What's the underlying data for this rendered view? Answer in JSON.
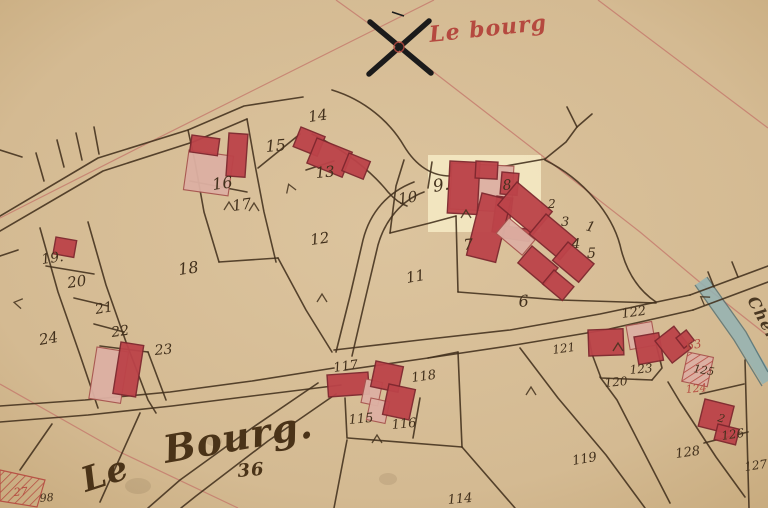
{
  "map": {
    "type": "cadastral-plan",
    "colors": {
      "paper": "#dcc49e",
      "paper_edge": "#c8ab7e",
      "ink": "#42301c",
      "building_red": "#bc4349",
      "building_red_stroke": "#7e272e",
      "building_pink": "#ddb0a3",
      "building_pink_stroke": "#a7544f",
      "red_ink": "#b5493f",
      "survey_line": "#c4786c",
      "water_blue": "#93b3b4",
      "water_edge": "#4e6e74",
      "highlight": "#f7eec8",
      "cross": "#1b1b1b"
    },
    "titles": [
      {
        "text": "Le bourg",
        "x": 430,
        "y": 42,
        "size": 22,
        "rot": -6,
        "color": "#b5493f"
      },
      {
        "text": "Le",
        "x": 86,
        "y": 492,
        "size": 34,
        "rot": -18,
        "color": "#4a3318"
      },
      {
        "text": "Bourg.",
        "x": 166,
        "y": 463,
        "size": 38,
        "rot": -10,
        "color": "#4a3318"
      },
      {
        "text": "36",
        "x": 238,
        "y": 477,
        "size": 18,
        "rot": -5,
        "color": "#4a3318"
      },
      {
        "text": "Chem",
        "x": 747,
        "y": 300,
        "size": 16,
        "rot": 62,
        "color": "#4a3822"
      }
    ],
    "parcel_labels": [
      {
        "text": "14",
        "x": 309,
        "y": 122,
        "size": 15,
        "rot": -8
      },
      {
        "text": "15",
        "x": 266,
        "y": 152,
        "size": 16,
        "rot": -5
      },
      {
        "text": "16",
        "x": 213,
        "y": 190,
        "size": 16,
        "rot": -8
      },
      {
        "text": "13",
        "x": 316,
        "y": 178,
        "size": 15,
        "rot": -5
      },
      {
        "text": "17",
        "x": 233,
        "y": 211,
        "size": 15,
        "rot": -8
      },
      {
        "text": "10",
        "x": 399,
        "y": 204,
        "size": 15,
        "rot": -8
      },
      {
        "text": "9.",
        "x": 434,
        "y": 192,
        "size": 17,
        "rot": -10
      },
      {
        "text": "8",
        "x": 503,
        "y": 190,
        "size": 14,
        "rot": -5
      },
      {
        "text": "2",
        "x": 548,
        "y": 208,
        "size": 12,
        "rot": 0
      },
      {
        "text": "3",
        "x": 561,
        "y": 226,
        "size": 13,
        "rot": 0
      },
      {
        "text": "1",
        "x": 585,
        "y": 230,
        "size": 14,
        "rot": 15
      },
      {
        "text": "4",
        "x": 572,
        "y": 248,
        "size": 13,
        "rot": 0
      },
      {
        "text": "5",
        "x": 587,
        "y": 258,
        "size": 14,
        "rot": 0
      },
      {
        "text": "7",
        "x": 464,
        "y": 250,
        "size": 15,
        "rot": -5
      },
      {
        "text": "12",
        "x": 311,
        "y": 245,
        "size": 15,
        "rot": -8
      },
      {
        "text": "11",
        "x": 407,
        "y": 283,
        "size": 15,
        "rot": -10
      },
      {
        "text": "18",
        "x": 179,
        "y": 275,
        "size": 16,
        "rot": -8
      },
      {
        "text": "19.",
        "x": 42,
        "y": 264,
        "size": 14,
        "rot": -8
      },
      {
        "text": "20",
        "x": 68,
        "y": 288,
        "size": 15,
        "rot": -8
      },
      {
        "text": "21",
        "x": 96,
        "y": 314,
        "size": 14,
        "rot": -10
      },
      {
        "text": "22",
        "x": 112,
        "y": 337,
        "size": 14,
        "rot": -8
      },
      {
        "text": "23",
        "x": 155,
        "y": 355,
        "size": 14,
        "rot": -5
      },
      {
        "text": "24",
        "x": 40,
        "y": 345,
        "size": 15,
        "rot": -10
      },
      {
        "text": "6",
        "x": 519,
        "y": 307,
        "size": 16,
        "rot": -5
      },
      {
        "text": "122",
        "x": 622,
        "y": 318,
        "size": 13,
        "rot": -8
      },
      {
        "text": "121",
        "x": 553,
        "y": 354,
        "size": 12,
        "rot": -8
      },
      {
        "text": "123",
        "x": 630,
        "y": 374,
        "size": 12,
        "rot": -5
      },
      {
        "text": "120",
        "x": 605,
        "y": 387,
        "size": 12,
        "rot": -5
      },
      {
        "text": "63",
        "x": 687,
        "y": 350,
        "size": 12,
        "rot": -10,
        "color": "#b5493f"
      },
      {
        "text": "125",
        "x": 693,
        "y": 372,
        "size": 11,
        "rot": 10
      },
      {
        "text": "124",
        "x": 686,
        "y": 393,
        "size": 11,
        "rot": -5,
        "color": "#b5493f"
      },
      {
        "text": "2",
        "x": 717,
        "y": 421,
        "size": 11,
        "rot": 15
      },
      {
        "text": "117",
        "x": 334,
        "y": 372,
        "size": 13,
        "rot": -8
      },
      {
        "text": "118",
        "x": 412,
        "y": 382,
        "size": 13,
        "rot": -8
      },
      {
        "text": "115",
        "x": 349,
        "y": 424,
        "size": 13,
        "rot": -5
      },
      {
        "text": "116",
        "x": 392,
        "y": 429,
        "size": 13,
        "rot": -5
      },
      {
        "text": "119",
        "x": 573,
        "y": 465,
        "size": 13,
        "rot": -10
      },
      {
        "text": "128",
        "x": 676,
        "y": 458,
        "size": 13,
        "rot": -8
      },
      {
        "text": "126",
        "x": 722,
        "y": 440,
        "size": 12,
        "rot": -8
      },
      {
        "text": "127",
        "x": 745,
        "y": 471,
        "size": 12,
        "rot": -8
      },
      {
        "text": "114",
        "x": 448,
        "y": 504,
        "size": 13,
        "rot": -5
      },
      {
        "text": "27",
        "x": 14,
        "y": 496,
        "size": 11,
        "rot": -5,
        "color": "#b5493f"
      },
      {
        "text": "98",
        "x": 40,
        "y": 502,
        "size": 11,
        "rot": -5
      }
    ],
    "buildings": [
      {
        "x": 189,
        "y": 150,
        "w": 45,
        "h": 40,
        "rot": 8,
        "fill": "pink"
      },
      {
        "x": 192,
        "y": 135,
        "w": 28,
        "h": 17,
        "rot": 8,
        "fill": "red"
      },
      {
        "x": 229,
        "y": 133,
        "w": 19,
        "h": 43,
        "rot": 4,
        "fill": "red"
      },
      {
        "x": 301,
        "y": 127,
        "w": 26,
        "h": 21,
        "rot": 22,
        "fill": "red"
      },
      {
        "x": 317,
        "y": 138,
        "w": 38,
        "h": 27,
        "rot": 22,
        "fill": "red"
      },
      {
        "x": 349,
        "y": 153,
        "w": 23,
        "h": 19,
        "rot": 22,
        "fill": "red"
      },
      {
        "x": 56,
        "y": 237,
        "w": 21,
        "h": 17,
        "rot": 10,
        "fill": "red"
      },
      {
        "x": 97,
        "y": 347,
        "w": 32,
        "h": 52,
        "rot": 9,
        "fill": "pink"
      },
      {
        "x": 121,
        "y": 342,
        "w": 23,
        "h": 52,
        "rot": 9,
        "fill": "red"
      },
      {
        "x": 452,
        "y": 163,
        "w": 62,
        "h": 46,
        "rot": 3,
        "fill": "pink"
      },
      {
        "x": 450,
        "y": 161,
        "w": 30,
        "h": 52,
        "rot": 3,
        "fill": "red"
      },
      {
        "x": 476,
        "y": 161,
        "w": 22,
        "h": 17,
        "rot": 3,
        "fill": "red"
      },
      {
        "x": 502,
        "y": 172,
        "w": 17,
        "h": 22,
        "rot": 5,
        "fill": "red"
      },
      {
        "x": 497,
        "y": 196,
        "w": 16,
        "h": 36,
        "rot": 8,
        "fill": "red"
      },
      {
        "x": 482,
        "y": 193,
        "w": 30,
        "h": 64,
        "rot": 14,
        "fill": "red"
      },
      {
        "x": 505,
        "y": 226,
        "w": 26,
        "h": 12,
        "rot": 8,
        "fill": "red"
      },
      {
        "x": 509,
        "y": 218,
        "w": 34,
        "h": 20,
        "rot": 40,
        "fill": "pink"
      },
      {
        "x": 517,
        "y": 182,
        "w": 46,
        "h": 30,
        "rot": 40,
        "fill": "red"
      },
      {
        "x": 546,
        "y": 214,
        "w": 40,
        "h": 26,
        "rot": 40,
        "fill": "red"
      },
      {
        "x": 568,
        "y": 242,
        "w": 34,
        "h": 24,
        "rot": 40,
        "fill": "red"
      },
      {
        "x": 532,
        "y": 246,
        "w": 34,
        "h": 22,
        "rot": 40,
        "fill": "red"
      },
      {
        "x": 554,
        "y": 270,
        "w": 26,
        "h": 18,
        "rot": 40,
        "fill": "red"
      },
      {
        "x": 327,
        "y": 375,
        "w": 41,
        "h": 22,
        "rot": -4,
        "fill": "red"
      },
      {
        "x": 366,
        "y": 379,
        "w": 17,
        "h": 24,
        "rot": 12,
        "fill": "pink"
      },
      {
        "x": 371,
        "y": 398,
        "w": 19,
        "h": 22,
        "rot": 12,
        "fill": "pink"
      },
      {
        "x": 376,
        "y": 361,
        "w": 28,
        "h": 26,
        "rot": 12,
        "fill": "red"
      },
      {
        "x": 389,
        "y": 384,
        "w": 27,
        "h": 31,
        "rot": 12,
        "fill": "red"
      },
      {
        "x": 588,
        "y": 330,
        "w": 35,
        "h": 26,
        "rot": -2,
        "fill": "red"
      },
      {
        "x": 626,
        "y": 326,
        "w": 26,
        "h": 24,
        "rot": -10,
        "fill": "pink"
      },
      {
        "x": 634,
        "y": 337,
        "w": 25,
        "h": 28,
        "rot": -10,
        "fill": "red"
      },
      {
        "x": 655,
        "y": 341,
        "w": 24,
        "h": 28,
        "rot": -38,
        "fill": "red"
      },
      {
        "x": 676,
        "y": 338,
        "w": 13,
        "h": 13,
        "rot": -38,
        "fill": "red"
      },
      {
        "x": 688,
        "y": 352,
        "w": 26,
        "h": 30,
        "rot": 12,
        "fill": "pink",
        "hatch": true
      },
      {
        "x": 705,
        "y": 399,
        "w": 30,
        "h": 28,
        "rot": 14,
        "fill": "red"
      },
      {
        "x": 718,
        "y": 424,
        "w": 22,
        "h": 16,
        "rot": 14,
        "fill": "red"
      }
    ],
    "boundaries": [
      "M 0,216 L 98,158 L 188,130 L 244,106 L 303,97",
      "M 0,231 L 103,171 L 193,142 L 247,119",
      "M 64,167 L 57,140",
      "M 82,160 L 76,133",
      "M 99,154 L 94,127",
      "M 44,181 L 36,153",
      "M 0,150 L 22,157",
      "M 188,130 L 195,162 L 204,212 L 219,262",
      "M 247,119 L 256,170 L 264,212 L 276,262",
      "M 190,181 L 247,192",
      "M 219,262 L 278,258",
      "M 258,168 L 300,134",
      "M 306,170 L 334,161",
      "M 278,258 L 306,310 L 332,352",
      "M 332,90 C 365,100 390,122 404,146 C 416,166 432,176 450,176 L 545,159",
      "M 312,134 C 345,150 372,172 388,192 C 395,200 401,204 407,206",
      "M 545,159 L 566,142 L 577,127",
      "M 577,127 L 567,107",
      "M 577,127 L 592,114",
      "M 545,160 C 585,180 612,215 620,245 C 626,272 638,290 656,302",
      "M 404,160 L 396,186 L 390,233",
      "M 432,162 L 428,188",
      "M 390,233 L 430,223 L 456,216",
      "M 450,176 L 452,163",
      "M 456,216 L 458,292",
      "M 458,292 L 560,300 L 656,303",
      "M 336,352 L 350,296 L 363,240 C 370,212 388,192 414,182",
      "M 352,356 L 365,300 L 378,245 C 385,220 402,200 424,192",
      "M 334,350 L 420,340 L 510,330 L 600,314 L 690,295",
      "M 345,370 L 428,358 L 515,345 L 605,330 L 693,310",
      "M 690,295 L 768,266",
      "M 693,310 L 768,282",
      "M 714,287 L 708,272",
      "M 738,277 L 732,262",
      "M 0,406 L 85,400 L 170,392 L 252,381 L 334,368",
      "M 0,422 L 88,415 L 172,406 L 252,396 L 341,385",
      "M 318,383 L 252,428 L 180,480 L 148,508",
      "M 336,394 L 268,441 L 196,496 L 181,508",
      "M 140,413 L 100,502",
      "M 52,424 L 20,470",
      "M 40,228 L 58,292 L 80,355 L 98,408",
      "M 88,222 L 106,285 L 126,342 L 148,400 L 156,413",
      "M 46,266 L 94,274",
      "M 74,298 L 108,306",
      "M 94,324 L 124,332",
      "M 100,346 L 148,352",
      "M 148,352 L 166,400",
      "M 0,256 L 18,250",
      "M 348,438 L 462,447",
      "M 458,352 L 462,447",
      "M 428,358 L 458,352",
      "M 347,440 L 334,508",
      "M 462,447 L 515,508",
      "M 520,348 L 558,398 L 606,455 L 645,508",
      "M 600,377 L 617,400 L 670,503",
      "M 668,382 L 680,402 L 716,457 L 745,497",
      "M 588,332 L 592,354 L 601,378 L 652,380",
      "M 652,380 L 662,368 L 656,344",
      "M 700,394 L 744,384",
      "M 704,443 L 748,432",
      "M 745,360 L 749,508",
      "M 420,398 L 413,438",
      "M 345,398 L 347,438"
    ],
    "red_lines": [
      "M 336,0 L 400,46 L 545,158 L 640,232 L 702,284 L 768,336",
      "M 434,0 L 330,52 L 150,142 L 0,218",
      "M 598,0 L 768,128",
      "M 0,384 L 120,452 L 238,508"
    ],
    "survey_cross": {
      "lines": [
        "M 370,22 L 431,73",
        "M 429,21 L 369,74"
      ],
      "tick": "M 392,12 L 404,16",
      "circle": {
        "cx": 399,
        "cy": 47,
        "r": 5
      }
    },
    "highlight": {
      "x": 428,
      "y": 155,
      "w": 113,
      "h": 77,
      "opacity": 0.8
    },
    "water_strip": {
      "band": "M 701,281 L 740,336 L 768,381",
      "edges": [
        "M 695,285 L 734,340 L 762,386",
        "M 707,277 L 746,332 L 768,372"
      ],
      "width": 13
    },
    "corner_strip": {
      "path": "M 0,470 L 45,480 L 37,507 L 0,501 Z"
    },
    "tie_marks": [
      [
        290,
        188,
        -20
      ],
      [
        229,
        206,
        0
      ],
      [
        254,
        207,
        0
      ],
      [
        322,
        298,
        0
      ],
      [
        466,
        214,
        0
      ],
      [
        18,
        303,
        -80
      ],
      [
        618,
        347,
        0
      ],
      [
        377,
        439,
        0
      ],
      [
        531,
        391,
        0
      ],
      [
        704,
        299,
        -55
      ]
    ],
    "stains": [
      {
        "cx": 138,
        "cy": 486,
        "rx": 13,
        "ry": 8
      },
      {
        "cx": 388,
        "cy": 479,
        "rx": 9,
        "ry": 6
      },
      {
        "cx": 214,
        "cy": 441,
        "rx": 8,
        "ry": 5
      }
    ]
  }
}
